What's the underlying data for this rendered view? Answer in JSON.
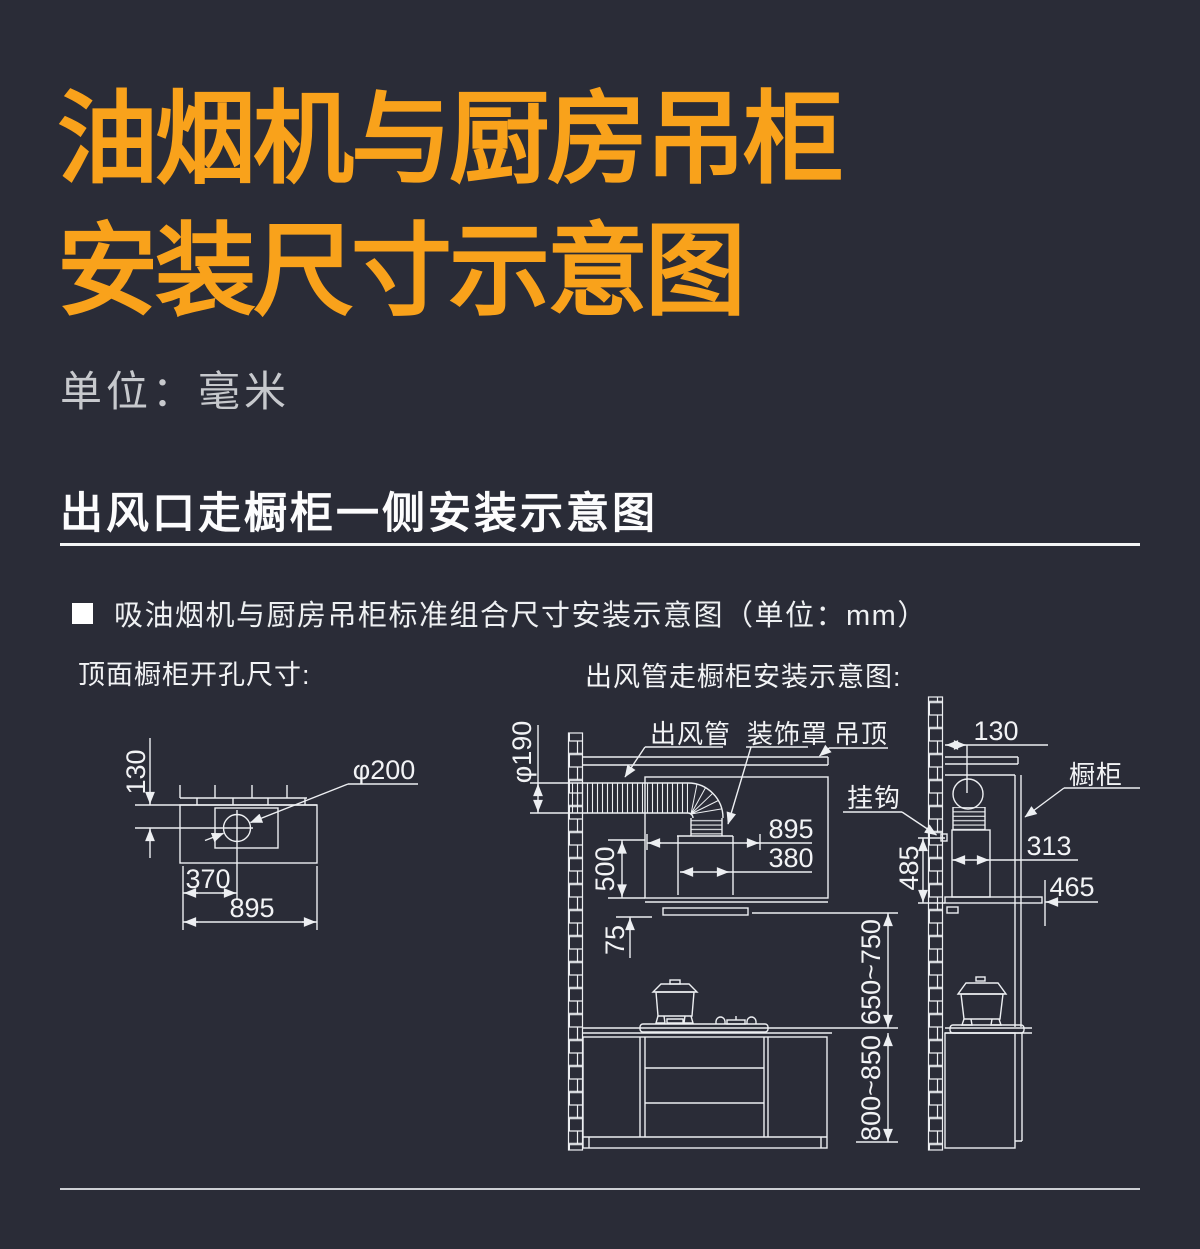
{
  "page": {
    "background": "#2a2c37",
    "accent_orange": "#f9a21b",
    "line_color": "#edeff2"
  },
  "title": {
    "line1": "油烟机与厨房吊柜",
    "line2": "安装尺寸示意图"
  },
  "unit_note": "单位：毫米",
  "section": {
    "heading": "出风口走橱柜一侧安装示意图",
    "bullet": "吸油烟机与厨房吊柜标准组合尺寸安装示意图（单位：mm）"
  },
  "left": {
    "caption": "顶面橱柜开孔尺寸:",
    "dim_depth": "130",
    "dim_hole": "φ200",
    "dim_offset": "370",
    "dim_width": "895"
  },
  "right": {
    "caption": "出风管走橱柜安装示意图:",
    "label_duct": "出风管",
    "label_cover": "装饰罩",
    "label_ceiling": "吊顶",
    "label_hook": "挂钩",
    "label_cabinet": "橱柜",
    "dim_duct_dia": "φ190",
    "dim_hood_width": "895",
    "dim_chimney_width": "380",
    "dim_hood_height": "500",
    "dim_gap": "75",
    "dim_hood_to_counter": "650~750",
    "dim_counter_height": "800~850",
    "dim_wall_offset": "130",
    "dim_hood_depth": "313",
    "dim_bottom_depth": "465",
    "dim_hook_height": "485"
  }
}
